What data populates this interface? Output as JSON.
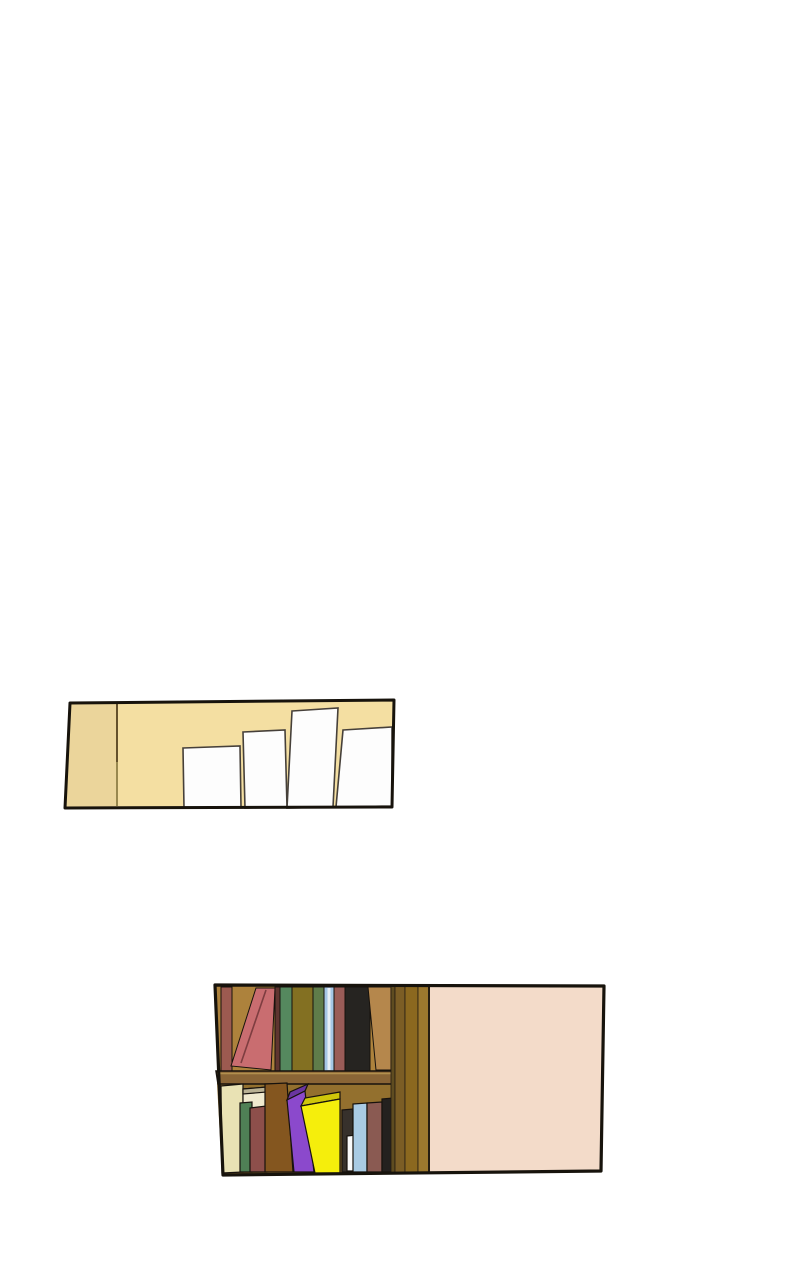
{
  "page": {
    "background_color": "#ffffff",
    "description": "webtoon comic page with two panels separated by wide white gutters"
  },
  "panel1": {
    "description": "tan studio wall corner with four blank white canvases leaning against it",
    "border_color": "#17130c",
    "wall_color": "#f4dfa2",
    "side_wall_color": "#ebd59b",
    "corner_line_top_color": "#54411f",
    "corner_line_bottom_color": "#8f7f46",
    "canvas_color": "#fdfdfd",
    "canvas_outline": "#46403a"
  },
  "panel2": {
    "description": "wooden bookshelf with two rows of books beside a blank pink wall",
    "border_color": "#17130c",
    "wall_color": "#f3dbc9",
    "wall_edge_color": "#241c12",
    "shelf_back_top_color": "#ad823c",
    "shelf_back_bottom_color": "#93702e",
    "shelf_board_color": "#8a6536",
    "shelf_board_highlight": "#b2904e",
    "outline_color": "#17120d",
    "plank_colors": [
      "#5f4c20",
      "#7b5d25",
      "#8b681f",
      "#9c782e"
    ],
    "top_shelf_books": [
      {
        "name": "dusty-maroon-book",
        "color": "#9c5a50"
      },
      {
        "name": "leaning-rose-book",
        "color": "#c96d70",
        "fold_color": "#7e3d40"
      },
      {
        "name": "dark-maroon-book",
        "color": "#5f3530"
      },
      {
        "name": "green-book",
        "color": "#55885e"
      },
      {
        "name": "mustard-book",
        "color": "#837022"
      },
      {
        "name": "olive-green-book",
        "color": "#5f7c4a"
      },
      {
        "name": "light-blue-book",
        "color": "#a5c6e6",
        "stripe_color": "#e6eef6"
      },
      {
        "name": "maroon-book",
        "color": "#9a5c58"
      },
      {
        "name": "black-book",
        "color": "#262421"
      },
      {
        "name": "leaning-tan-book",
        "color": "#b5874c"
      }
    ],
    "bottom_shelf_books": [
      {
        "name": "cream-book",
        "color": "#e9e2b4"
      },
      {
        "name": "ivory-book",
        "color": "#f0eacf",
        "top_color": "#b9b194"
      },
      {
        "name": "green-book",
        "color": "#4f8055"
      },
      {
        "name": "maroon-book",
        "color": "#8d4f4b"
      },
      {
        "name": "brown-book",
        "color": "#84561f"
      },
      {
        "name": "purple-book",
        "color": "#8b49cc",
        "top_color": "#6a35a0"
      },
      {
        "name": "yellow-book",
        "color": "#f5ee0c",
        "top_color": "#cfc70a"
      },
      {
        "name": "dark-brown-book",
        "color": "#37312c"
      },
      {
        "name": "white-book",
        "color": "#fafafa"
      },
      {
        "name": "light-blue-book",
        "color": "#a9cbe4"
      },
      {
        "name": "rosewood-book",
        "color": "#8a5a52"
      },
      {
        "name": "black-book",
        "color": "#24211f"
      }
    ]
  }
}
